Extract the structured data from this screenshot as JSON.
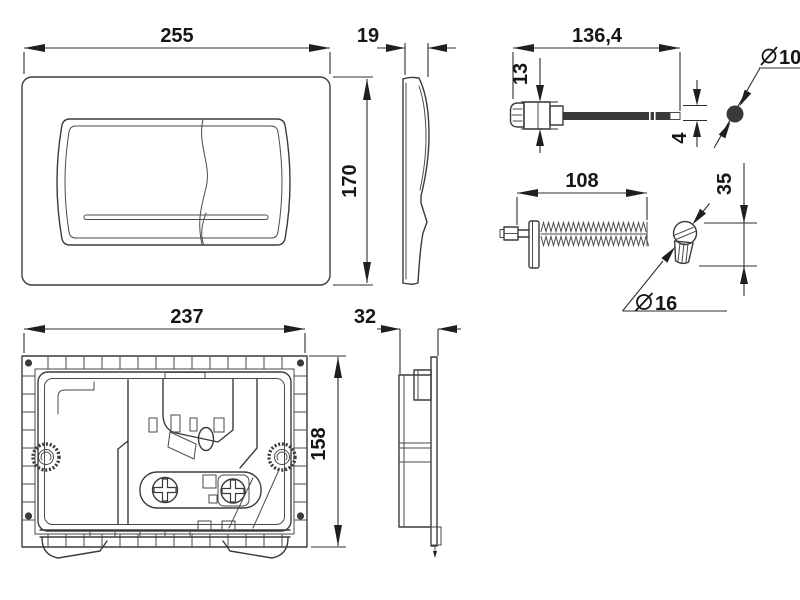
{
  "canvas": {
    "background": "#ffffff",
    "line_color": "#3b3b3b",
    "text_color": "#161616"
  },
  "dimensions": {
    "plate_width": "255",
    "plate_height": "170",
    "plate_depth": "19",
    "rod_length": "136,4",
    "rod_head_height": "13",
    "rod_tip_thickness": "4",
    "rod_end_diameter": {
      "symbol": "∅",
      "value": "10"
    },
    "spindle_length": "108",
    "knob_height": "35",
    "knob_diameter": {
      "symbol": "∅",
      "value": "16"
    },
    "frame_width": "237",
    "frame_height": "158",
    "frame_depth": "32"
  }
}
